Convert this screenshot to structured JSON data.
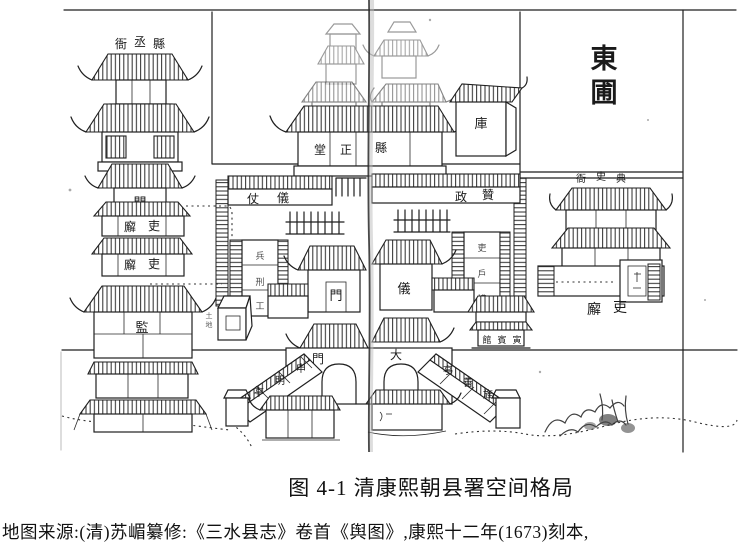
{
  "figure": {
    "caption": "图 4-1 清康熙朝县署空间格局",
    "source": "地图来源:(清)苏嵋纂修:《三水县志》卷首《舆图》,康熙十二年(1673)刻本,"
  },
  "map": {
    "ink_color": "#1f1f1f",
    "paper_color": "#ffffff",
    "labels": {
      "dongpu": [
        "東",
        "圃"
      ],
      "xianchengya": [
        "衙",
        "丞",
        "縣"
      ],
      "gate_men": "門",
      "lixie_west_1": [
        "廨",
        "吏"
      ],
      "lixie_west_2": [
        "廨",
        "吏"
      ],
      "jian": "監",
      "zhengtang": [
        "堂",
        "正",
        "縣"
      ],
      "ku": "庫",
      "yizhang": [
        "仗",
        "儀"
      ],
      "zanzheng": [
        "政",
        "贊"
      ],
      "west_rooms": [
        "兵",
        "刑",
        "工"
      ],
      "east_rooms": [
        "吏",
        "戶",
        "禮"
      ],
      "yimen": [
        "門",
        "儀"
      ],
      "tudi": [
        "土",
        "地"
      ],
      "yinbinguan": [
        "館",
        "賓",
        "寅"
      ],
      "damen": [
        "門",
        "大"
      ],
      "shenmingting": [
        "亭",
        "明",
        "申"
      ],
      "jingshanting": [
        "亭",
        "善",
        "旌"
      ],
      "dianshiya": [
        "衙",
        "史",
        "典"
      ],
      "lixie_east": [
        "廨",
        "吏"
      ]
    }
  }
}
